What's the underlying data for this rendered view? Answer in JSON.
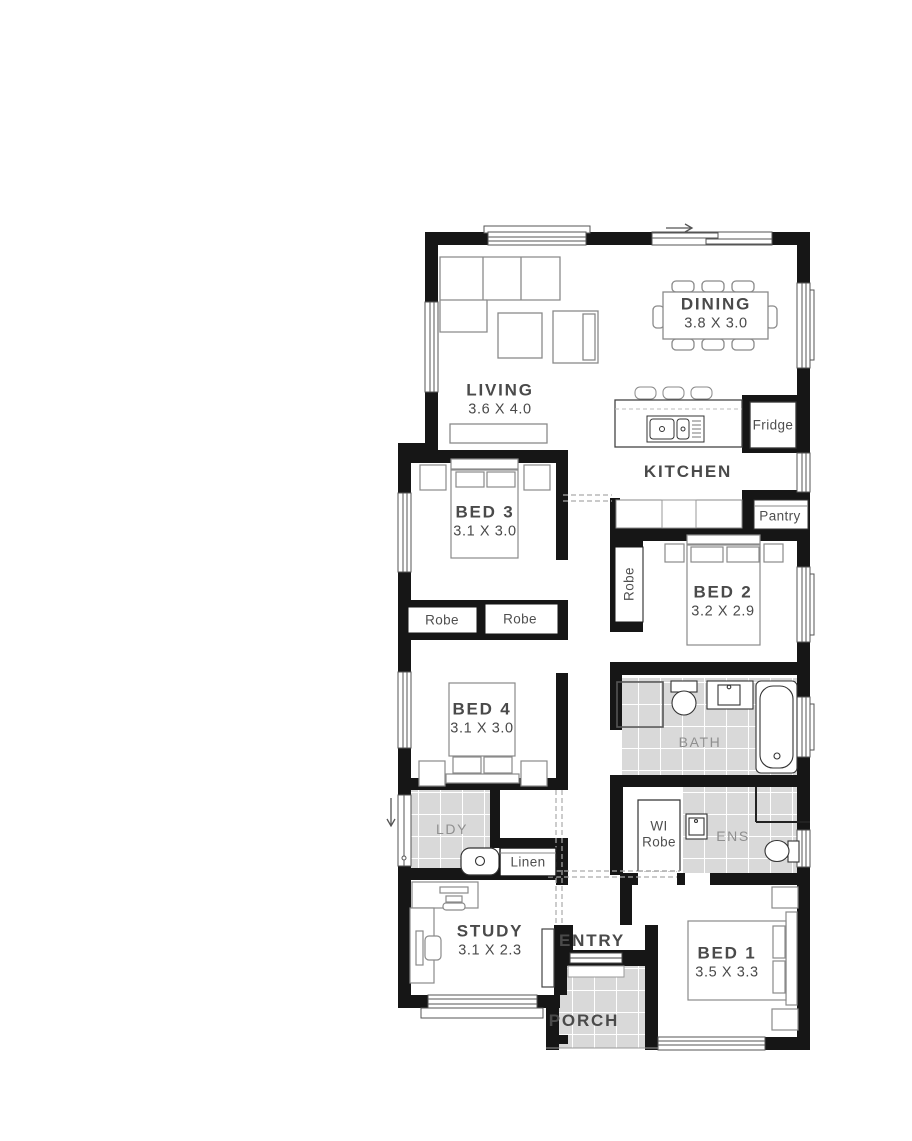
{
  "title": "single-storey-home-floor-plan",
  "colors": {
    "wall": "#161616",
    "room_label": "#4a4a4a",
    "tile_label": "#8f8f8f",
    "tile_fill": "#d9d9d9",
    "tile_grid": "#ffffff",
    "furniture_line": "#8a8a8a",
    "fixture_line": "#333333"
  },
  "labels": {
    "living": {
      "name": "LIVING",
      "dims": "3.6 X 4.0"
    },
    "dining": {
      "name": "DINING",
      "dims": "3.8 X 3.0"
    },
    "kitchen": {
      "name": "KITCHEN"
    },
    "fridge": {
      "name": "Fridge"
    },
    "pantry": {
      "name": "Pantry"
    },
    "bed3": {
      "name": "BED 3",
      "dims": "3.1 X 3.0"
    },
    "bed2": {
      "name": "BED 2",
      "dims": "3.2 X 2.9"
    },
    "bed4": {
      "name": "BED 4",
      "dims": "3.1 X 3.0"
    },
    "bed1": {
      "name": "BED 1",
      "dims": "3.5 X 3.3"
    },
    "study": {
      "name": "STUDY",
      "dims": "3.1 X 2.3"
    },
    "bath": {
      "name": "BATH"
    },
    "ens": {
      "name": "ENS"
    },
    "ldy": {
      "name": "LDY"
    },
    "linen": {
      "name": "Linen"
    },
    "entry": {
      "name": "ENTRY"
    },
    "porch": {
      "name": "PORCH"
    },
    "robe_bed3_left": {
      "name": "Robe"
    },
    "robe_bed3_right": {
      "name": "Robe"
    },
    "robe_bed2": {
      "name": "Robe"
    },
    "wi_robe": {
      "name": "WI\nRobe"
    }
  }
}
